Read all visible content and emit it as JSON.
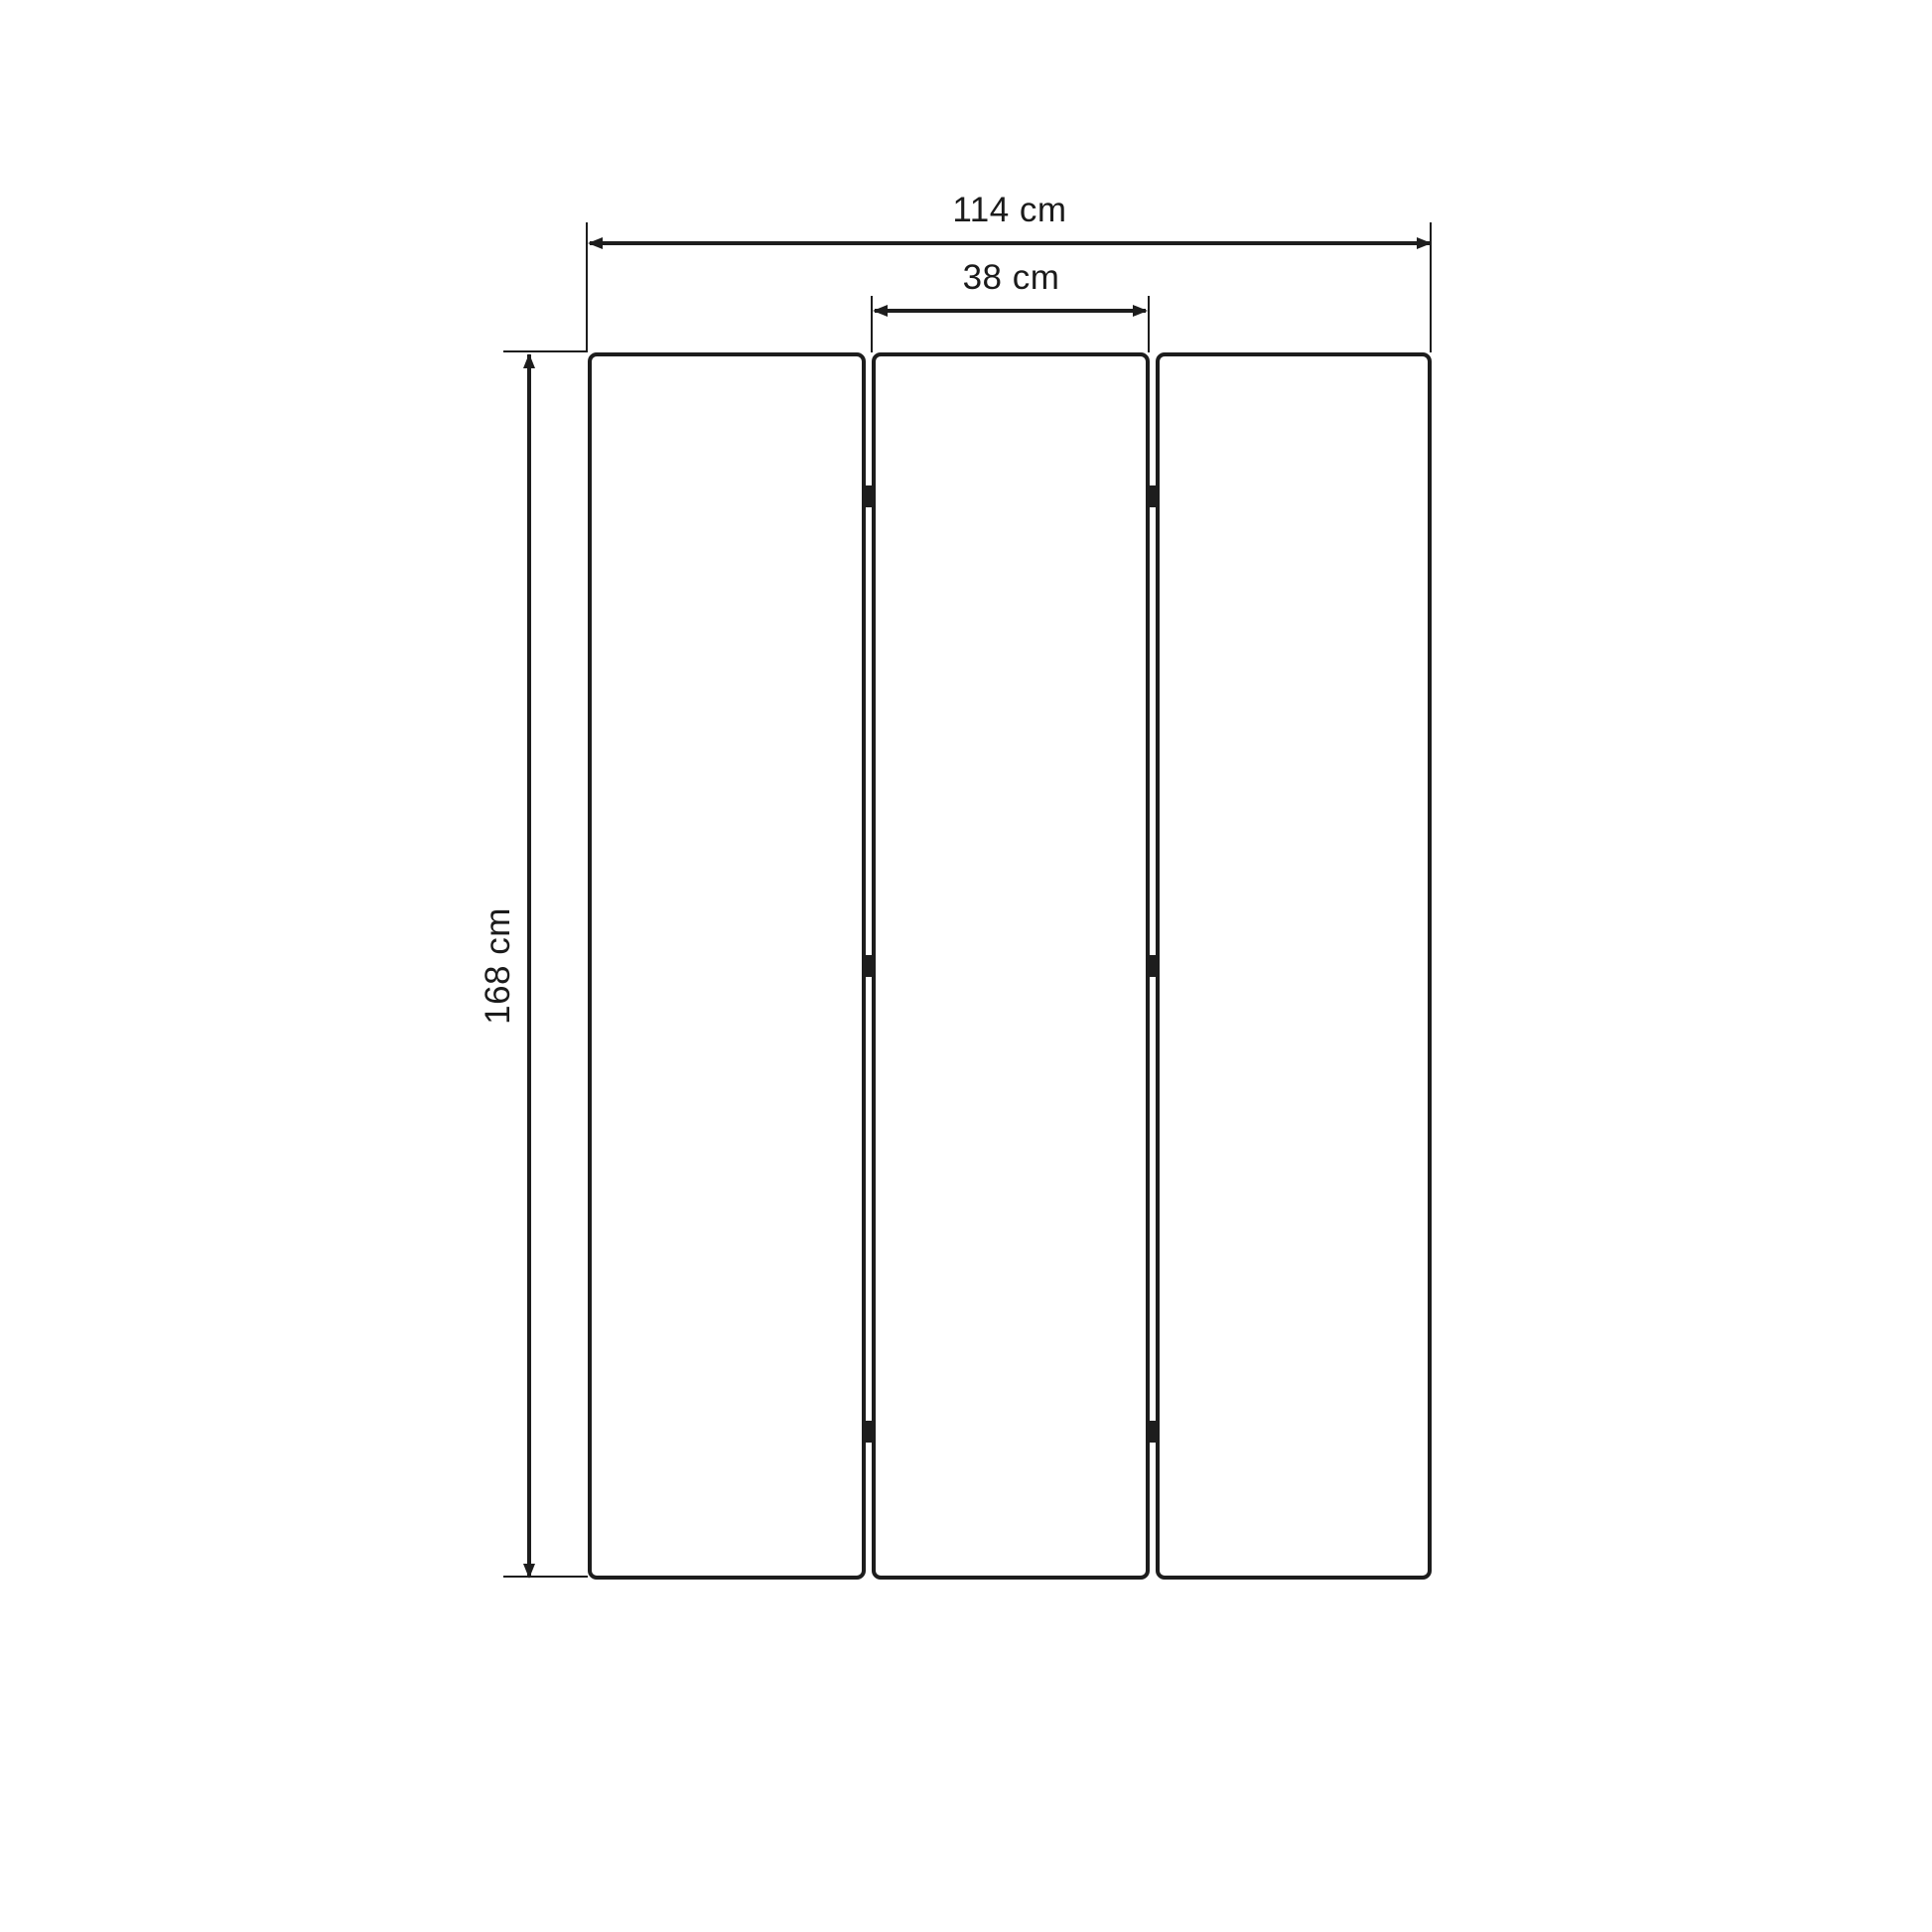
{
  "diagram": {
    "type": "furniture-dimension-drawing",
    "subject": "three-panel folding screen (room divider), front elevation",
    "units": "cm",
    "panel_count": 3,
    "hinges_per_joint": 3,
    "dimensions": {
      "total_width": {
        "label": "114 cm",
        "value": 114
      },
      "panel_width": {
        "label": "38 cm",
        "value": 38
      },
      "height": {
        "label": "168 cm",
        "value": 168
      }
    },
    "colors": {
      "line": "#1d1d1d",
      "text": "#1b1b1b",
      "background": "#ffffff",
      "panel_fill": "#ffffff"
    }
  }
}
